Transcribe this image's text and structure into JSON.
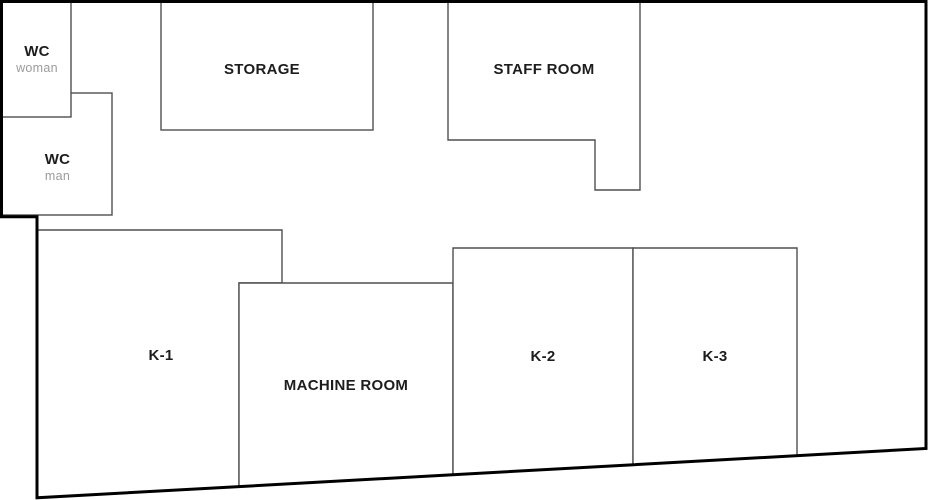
{
  "plan": {
    "colors": {
      "background": "#ffffff",
      "wall": "#000000",
      "partition": "#4f4f4f",
      "label": "#1d1d1d",
      "sublabel": "#9b9b9b"
    },
    "rooms": {
      "wc_woman": {
        "label": "WC",
        "sublabel": "woman"
      },
      "wc_man": {
        "label": "WC",
        "sublabel": "man"
      },
      "storage": {
        "label": "STORAGE"
      },
      "staff_room": {
        "label": "STAFF ROOM"
      },
      "k1": {
        "label": "K-1"
      },
      "machine_room": {
        "label": "MACHINE ROOM"
      },
      "k2": {
        "label": "K-2"
      },
      "k3": {
        "label": "K-3"
      }
    }
  }
}
